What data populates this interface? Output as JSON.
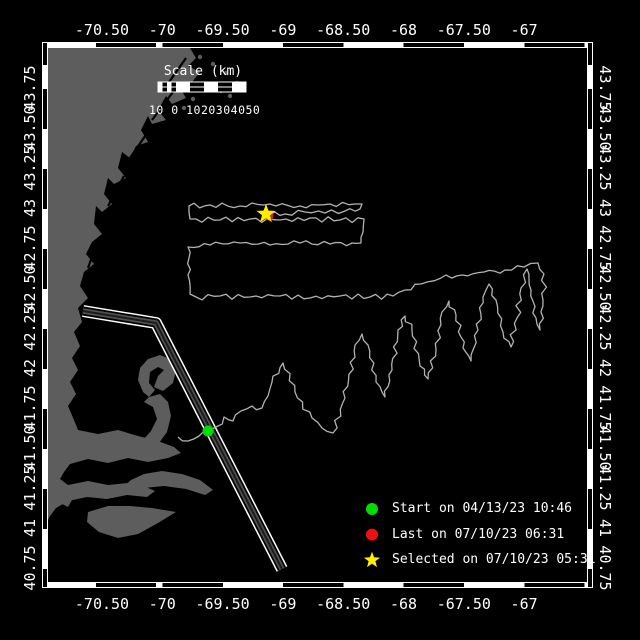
{
  "figure": {
    "width": 640,
    "height": 640,
    "background": "#000000"
  },
  "axes": {
    "lon": {
      "labels": [
        "-70.50",
        "-70",
        "-69.50",
        "-69",
        "-68.50",
        "-68",
        "-67.50",
        "-67"
      ],
      "first_px": 102,
      "step_px": 60.3
    },
    "lat": {
      "labels": [
        "43.75",
        "43.50",
        "43.25",
        "43",
        "42.75",
        "42.50",
        "42.25",
        "42",
        "41.75",
        "41.50",
        "41.25",
        "41",
        "40.75"
      ],
      "first_px": 88,
      "step_px": 40
    },
    "text_color": "#ffffff"
  },
  "frame": {
    "left": 42,
    "top": 42,
    "right": 593,
    "bottom": 588,
    "band_px": 6
  },
  "scalebar": {
    "title": "Scale (km)",
    "tick_text": "10 0 1020304050",
    "x": 158,
    "y": 82,
    "width": 88,
    "height": 10,
    "title_center_x": 203,
    "title_y": 64,
    "ticks_x": 149,
    "ticks_y": 103
  },
  "legend": {
    "icon_x": 372,
    "text_x": 392,
    "first_y": 509,
    "step_y": 25.6,
    "items": [
      {
        "marker": "circle",
        "color": "#00dd00",
        "label": "Start on 04/13/23 10:46"
      },
      {
        "marker": "circle",
        "color": "#ee1111",
        "label": "Last on 07/10/23 06:31"
      },
      {
        "marker": "star",
        "color": "#ffee00",
        "label": "Selected on 07/10/23 05:31"
      }
    ]
  },
  "map": {
    "clip": {
      "x": 48,
      "y": 48,
      "w": 539,
      "h": 534
    },
    "colors": {
      "ocean": "#000000",
      "land": "#5d5d5d",
      "track": "#b2b2b2",
      "streak": "#000000"
    },
    "markers": {
      "start": {
        "x": 208,
        "y": 431,
        "r": 5.5,
        "color": "#00dd00"
      },
      "last": {
        "x": 269,
        "y": 216,
        "r": 4.5,
        "color": "#ee1111"
      },
      "selected": {
        "x": 266,
        "y": 214,
        "r": 10,
        "color": "#ffee00"
      }
    },
    "corridor": {
      "d": "M83 311 L156 323 L282 569",
      "strokes": [
        [
          "#ffffff",
          12
        ],
        [
          "#000000",
          9
        ],
        [
          "#4f4f4f",
          5.5
        ],
        [
          "#1c1c1c",
          2
        ]
      ]
    },
    "land_polygons": [
      "48,48 190,48 196,58 188,66 200,72 192,82 180,88 186,98 172,104 166,96 158,110 166,120 152,124 148,116 141,130 148,142 136,146 130,158 122,152 118,168 126,178 114,184 108,178 104,194 112,204 102,212 96,206 94,224 102,234 92,242 86,254 94,264 84,272 80,286 88,298 78,308 82,322 74,332 80,346 72,358 78,370 70,382 76,394 68,406 74,420 78,430 98,434 118,430 138,436 158,441 174,447 181,453 168,458 148,462 128,458 108,463 88,459 70,464 64,472 60,479 68,485 88,481 108,485 128,483 146,487 155,491 147,497 127,495 107,499 87,497 68,501 56,508 50,516 48,520",
      "143,392 138,380 140,368 148,359 160,355 170,359 176,370 173,383 163,391 154,387 158,376 164,370 158,367 150,372 149,383 155,390 149,397",
      "149,397 160,394 168,402 171,416 167,432 159,443 149,448 143,440 151,431 157,419 153,407 144,402",
      "122,488 131,480 144,474 162,471 182,474 200,480 213,490 205,495 186,489 164,486 144,488 131,493",
      "88,512 108,506 130,506 152,508 176,512 158,523 138,534 118,538 99,532 87,522",
      "50,468 58,472 54,479 47,475",
      "56,482 65,487 61,494 53,490",
      "63,496 72,500 68,507 60,503"
    ],
    "islets": [
      [
        200,
        57
      ],
      [
        213,
        64
      ],
      [
        226,
        73
      ],
      [
        237,
        83
      ],
      [
        221,
        91
      ],
      [
        206,
        86
      ],
      [
        193,
        99
      ],
      [
        230,
        96
      ],
      [
        243,
        90
      ],
      [
        184,
        108
      ]
    ],
    "coast_streaks": [
      "M186 58 L162 92",
      "M176 88 L152 120",
      "M152 126 L130 158",
      "M124 176 L108 206",
      "M98 240 L88 268"
    ],
    "track_waypoints": [
      [
        178,
        437
      ],
      [
        188,
        441
      ],
      [
        199,
        436
      ],
      [
        208,
        431
      ],
      [
        216,
        427
      ],
      [
        224,
        417
      ],
      [
        233,
        421
      ],
      [
        241,
        411
      ],
      [
        252,
        406
      ],
      [
        262,
        408
      ],
      [
        268,
        396
      ],
      [
        272,
        382
      ],
      [
        283,
        363
      ],
      [
        295,
        392
      ],
      [
        312,
        418
      ],
      [
        322,
        428
      ],
      [
        333,
        433
      ],
      [
        345,
        398
      ],
      [
        355,
        345
      ],
      [
        362,
        334
      ],
      [
        368,
        345
      ],
      [
        376,
        382
      ],
      [
        385,
        397
      ],
      [
        392,
        370
      ],
      [
        398,
        330
      ],
      [
        405,
        316
      ],
      [
        412,
        330
      ],
      [
        420,
        366
      ],
      [
        428,
        379
      ],
      [
        436,
        350
      ],
      [
        442,
        312
      ],
      [
        449,
        301
      ],
      [
        456,
        315
      ],
      [
        463,
        348
      ],
      [
        471,
        361
      ],
      [
        478,
        330
      ],
      [
        483,
        297
      ],
      [
        489,
        284
      ],
      [
        496,
        300
      ],
      [
        503,
        332
      ],
      [
        511,
        347
      ],
      [
        517,
        318
      ],
      [
        521,
        288
      ],
      [
        527,
        269
      ],
      [
        531,
        290
      ],
      [
        536,
        318
      ],
      [
        540,
        330
      ],
      [
        543,
        300
      ],
      [
        544,
        274
      ],
      [
        538,
        263
      ],
      [
        524,
        267
      ],
      [
        505,
        270
      ],
      [
        484,
        272
      ],
      [
        462,
        275
      ],
      [
        441,
        278
      ],
      [
        421,
        284
      ],
      [
        405,
        290
      ],
      [
        393,
        296
      ],
      [
        370,
        297
      ],
      [
        340,
        296
      ],
      [
        310,
        298
      ],
      [
        280,
        296
      ],
      [
        250,
        297
      ],
      [
        220,
        296
      ],
      [
        196,
        297
      ],
      [
        190,
        294
      ],
      [
        188,
        275
      ],
      [
        189,
        258
      ],
      [
        188,
        247
      ],
      [
        210,
        245
      ],
      [
        240,
        243
      ],
      [
        270,
        245
      ],
      [
        300,
        243
      ],
      [
        330,
        244
      ],
      [
        352,
        243
      ],
      [
        361,
        243
      ],
      [
        363,
        232
      ],
      [
        364,
        219
      ],
      [
        340,
        220
      ],
      [
        310,
        218
      ],
      [
        280,
        220
      ],
      [
        250,
        219
      ],
      [
        220,
        220
      ],
      [
        196,
        219
      ],
      [
        190,
        219
      ],
      [
        189,
        212
      ],
      [
        189,
        206
      ],
      [
        210,
        205
      ],
      [
        240,
        206
      ],
      [
        270,
        204
      ],
      [
        300,
        206
      ],
      [
        330,
        204
      ],
      [
        355,
        204
      ],
      [
        362,
        204
      ],
      [
        360,
        209
      ],
      [
        345,
        211
      ],
      [
        325,
        213
      ],
      [
        305,
        212
      ],
      [
        285,
        214
      ],
      [
        270,
        214
      ],
      [
        266,
        214
      ]
    ]
  }
}
